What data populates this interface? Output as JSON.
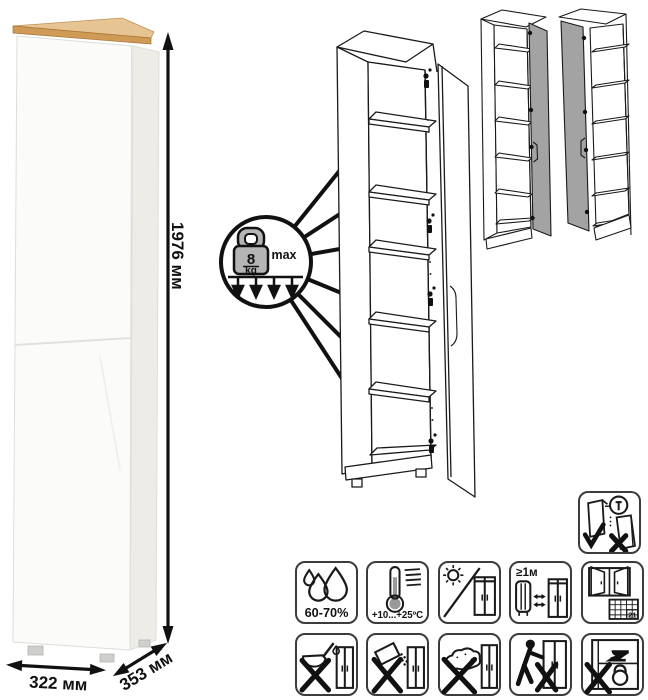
{
  "dimensions": {
    "height": "1976 мм",
    "width": "322 мм",
    "depth": "353 мм"
  },
  "load_callout": {
    "value": "8",
    "unit": "kg",
    "qualifier": "max"
  },
  "pictogram_labels": {
    "humidity": "60-70%",
    "temperature": "+10...+25ºC",
    "heat_distance": "≥1м",
    "acclimatize_days": "21"
  },
  "icons": [
    "shelf-load-8kg-icon",
    "humidity-drops-icon",
    "thermometer-icon",
    "no-direct-sun-icon",
    "heat-distance-icon",
    "window-ventilation-calendar-icon",
    "no-liquids-icon",
    "no-abrasive-powder-icon",
    "no-scouring-icon",
    "no-dragging-icon",
    "no-heavy-load-icon",
    "anchor-to-wall-icon"
  ],
  "accents": {
    "wood_top": "#cf9a55",
    "door_gray": "#a3a3a3",
    "line_black": "#111111"
  }
}
